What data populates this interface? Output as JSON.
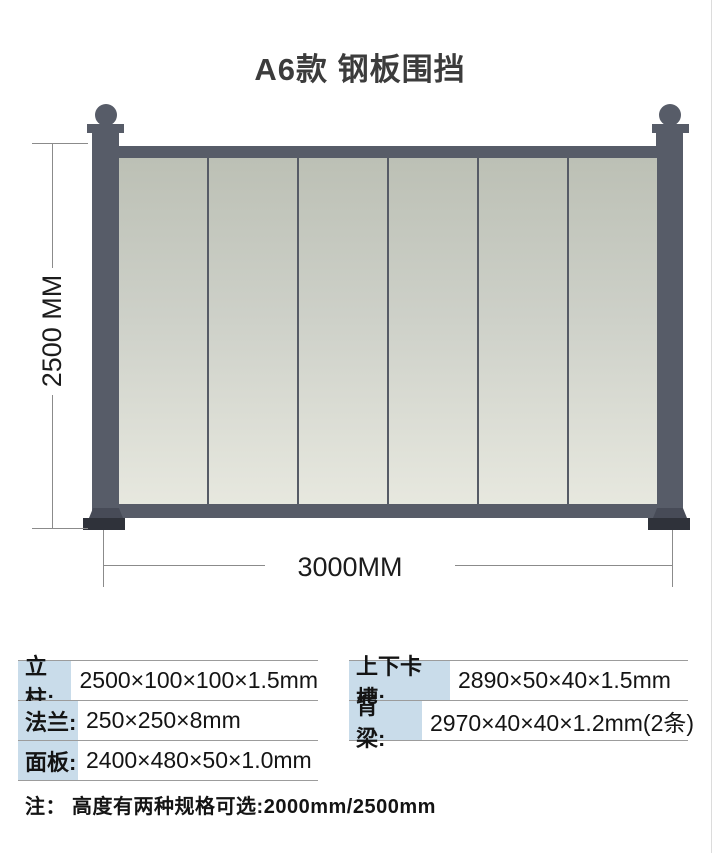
{
  "title": "A6款 钢板围挡",
  "diagram": {
    "height_label": "2500 MM",
    "width_label": "3000MM",
    "panel_count": 6,
    "colors": {
      "frame": "#575c68",
      "base_plate": "#2f323a",
      "panel_top": "#bcc0b5",
      "panel_bottom": "#e7e8df",
      "dimension_line": "#8b8b8b"
    }
  },
  "spec_table_left": {
    "rows": [
      {
        "label": "立柱:",
        "value": "2500×100×100×1.5mm"
      },
      {
        "label": "法兰:",
        "value": "250×250×8mm"
      },
      {
        "label": "面板:",
        "value": "2400×480×50×1.0mm"
      }
    ]
  },
  "spec_table_right": {
    "rows": [
      {
        "label": "上下卡槽:",
        "value": "2890×50×40×1.5mm"
      },
      {
        "label": "背　　梁:",
        "value": "2970×40×40×1.2mm(2条)"
      }
    ]
  },
  "note": "注： 高度有两种规格可选:2000mm/2500mm",
  "colors": {
    "label_bg": "#c9dcea",
    "separator": "#9c9c9c",
    "title_text": "#3c3c3c"
  }
}
